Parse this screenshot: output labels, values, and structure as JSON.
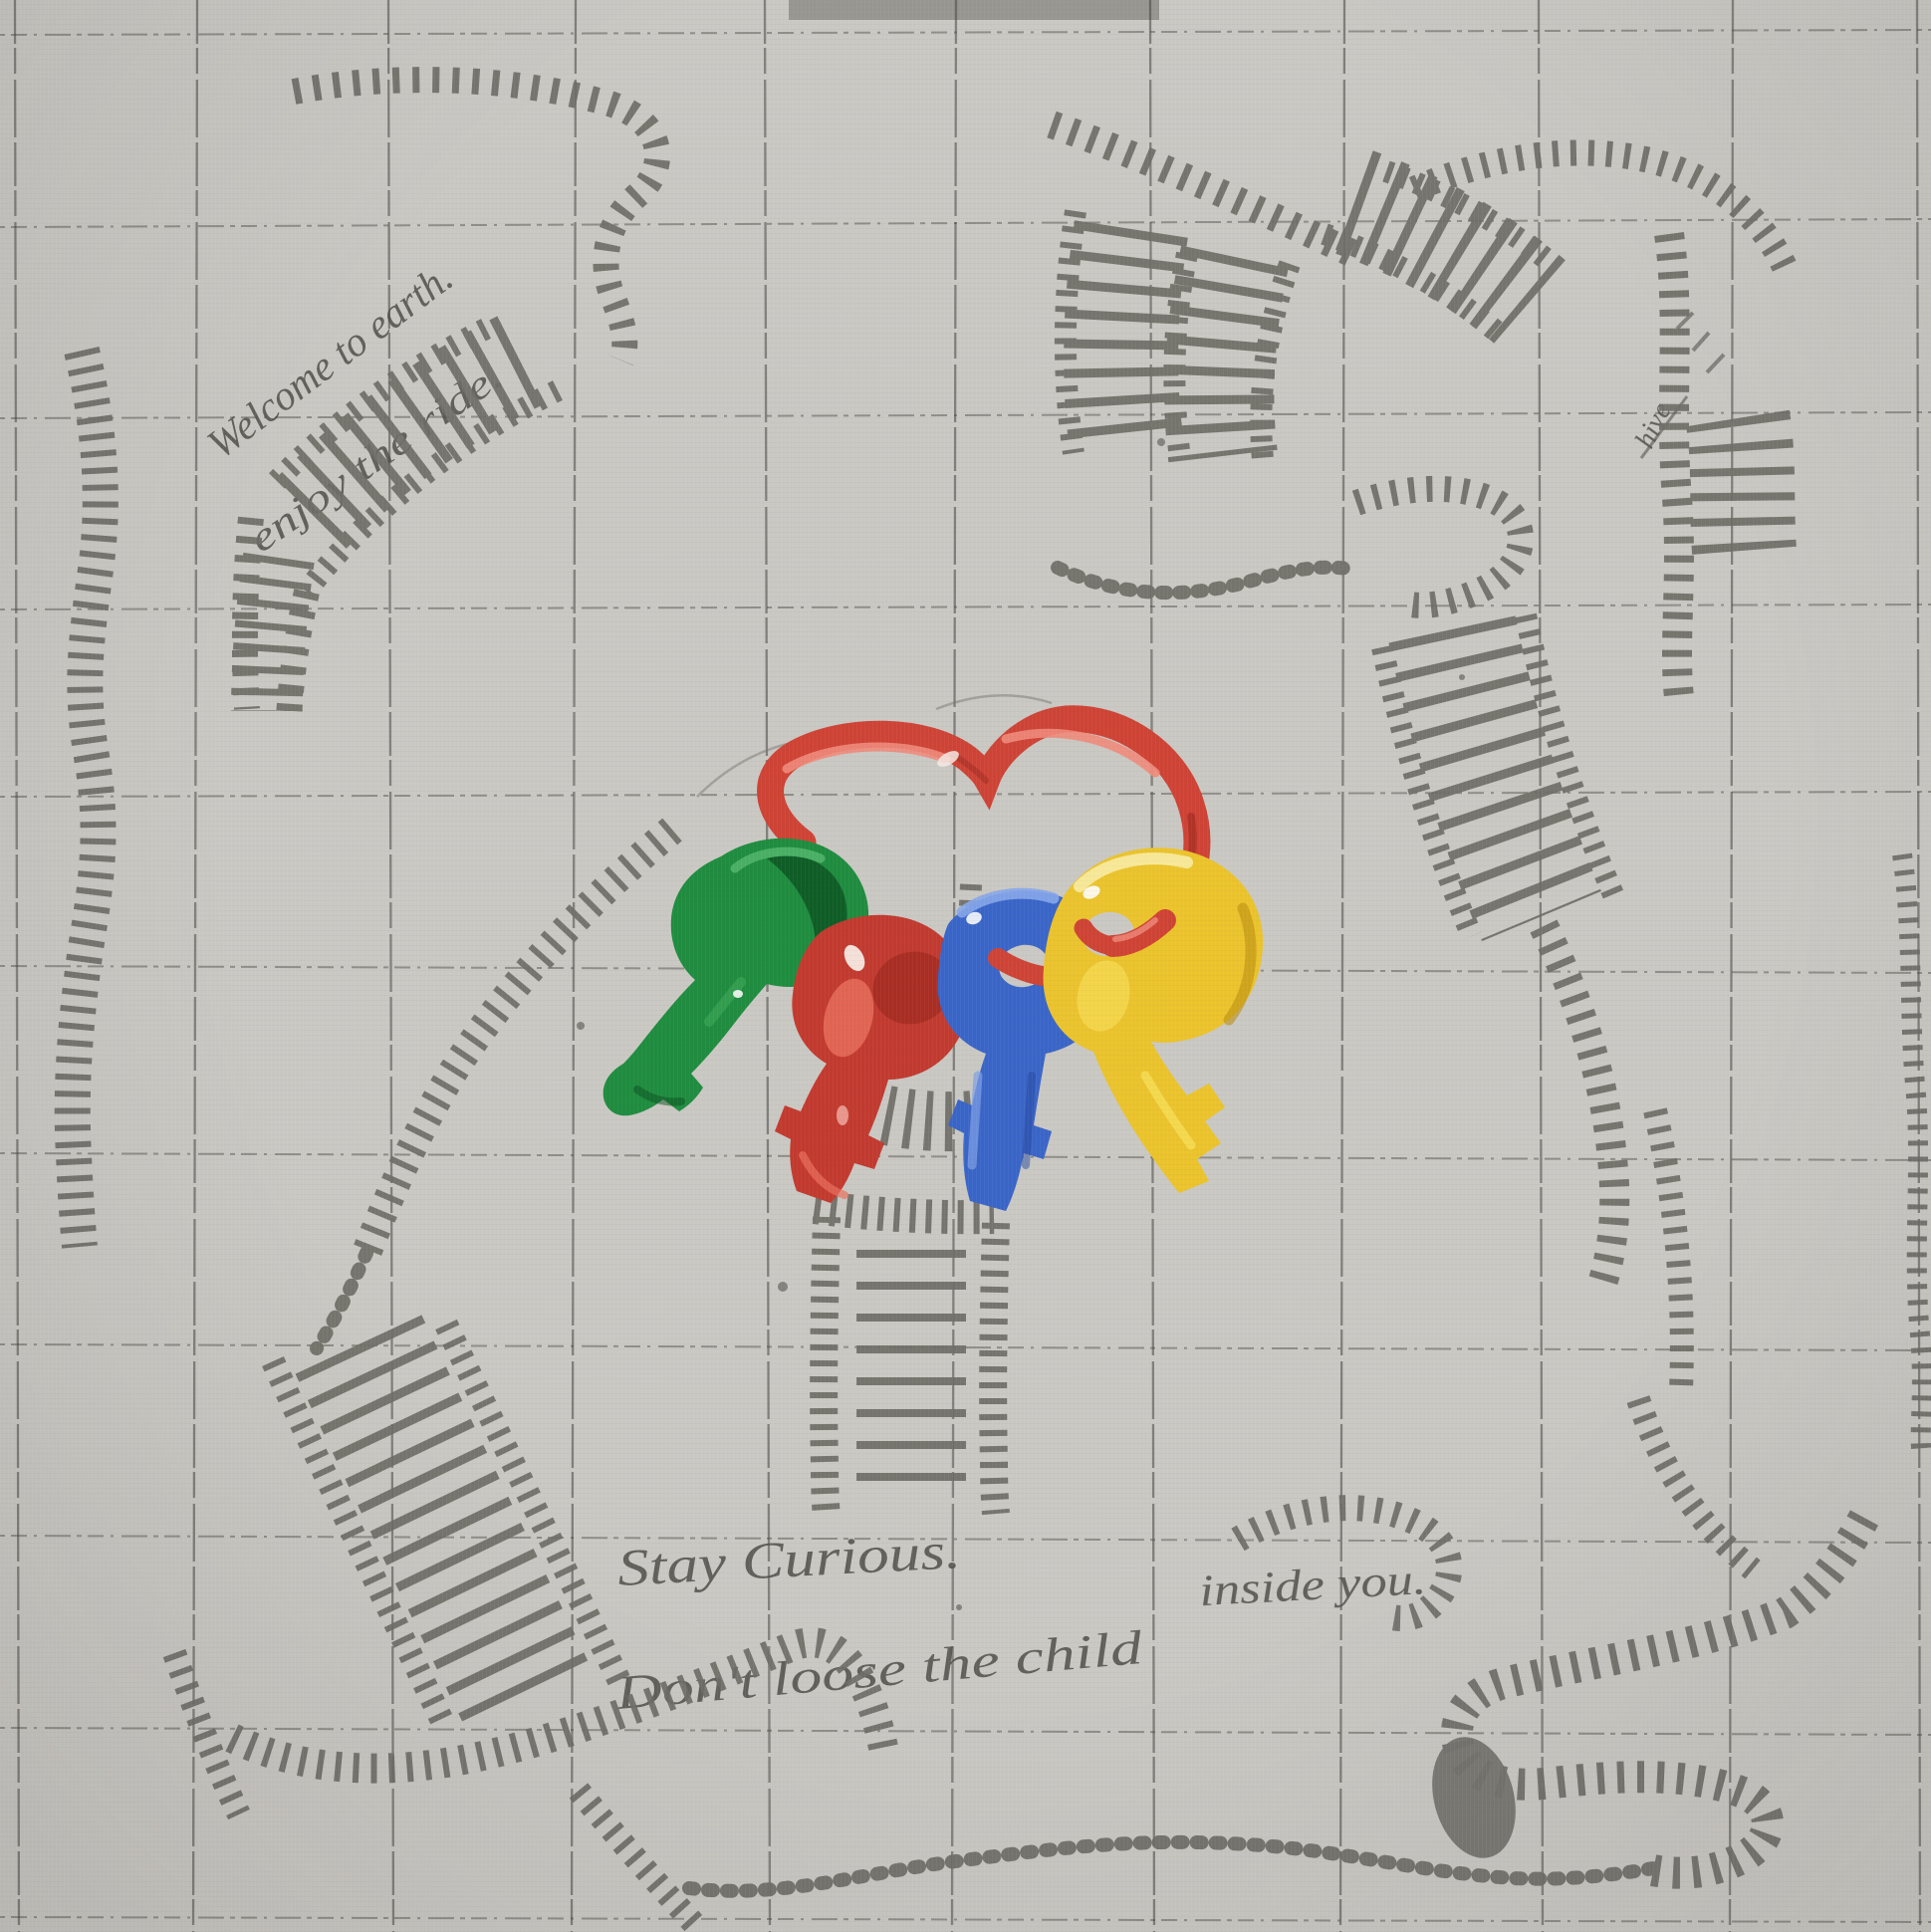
{
  "artwork": {
    "inscriptions": {
      "welcome_line1": "Welcome to earth.",
      "welcome_line2": "enjoy the ride.",
      "bottom_line1": "Stay Curious.",
      "bottom_line2_left": "Don't loose the child",
      "bottom_line2_right": "inside you.",
      "signature": "hive"
    },
    "palette": {
      "background": "#cac8c3",
      "grid_line": "#45443f",
      "ladder_gray": "#6e6d66",
      "pencil_text": "#4e4d47",
      "keyring_red": "#ce4335",
      "key_green": "#1f8c3f",
      "key_red": "#c23a2f",
      "key_blue": "#3a65c8",
      "key_yellow": "#eac32d",
      "top_edge_shadow": "#8f8d88"
    }
  }
}
